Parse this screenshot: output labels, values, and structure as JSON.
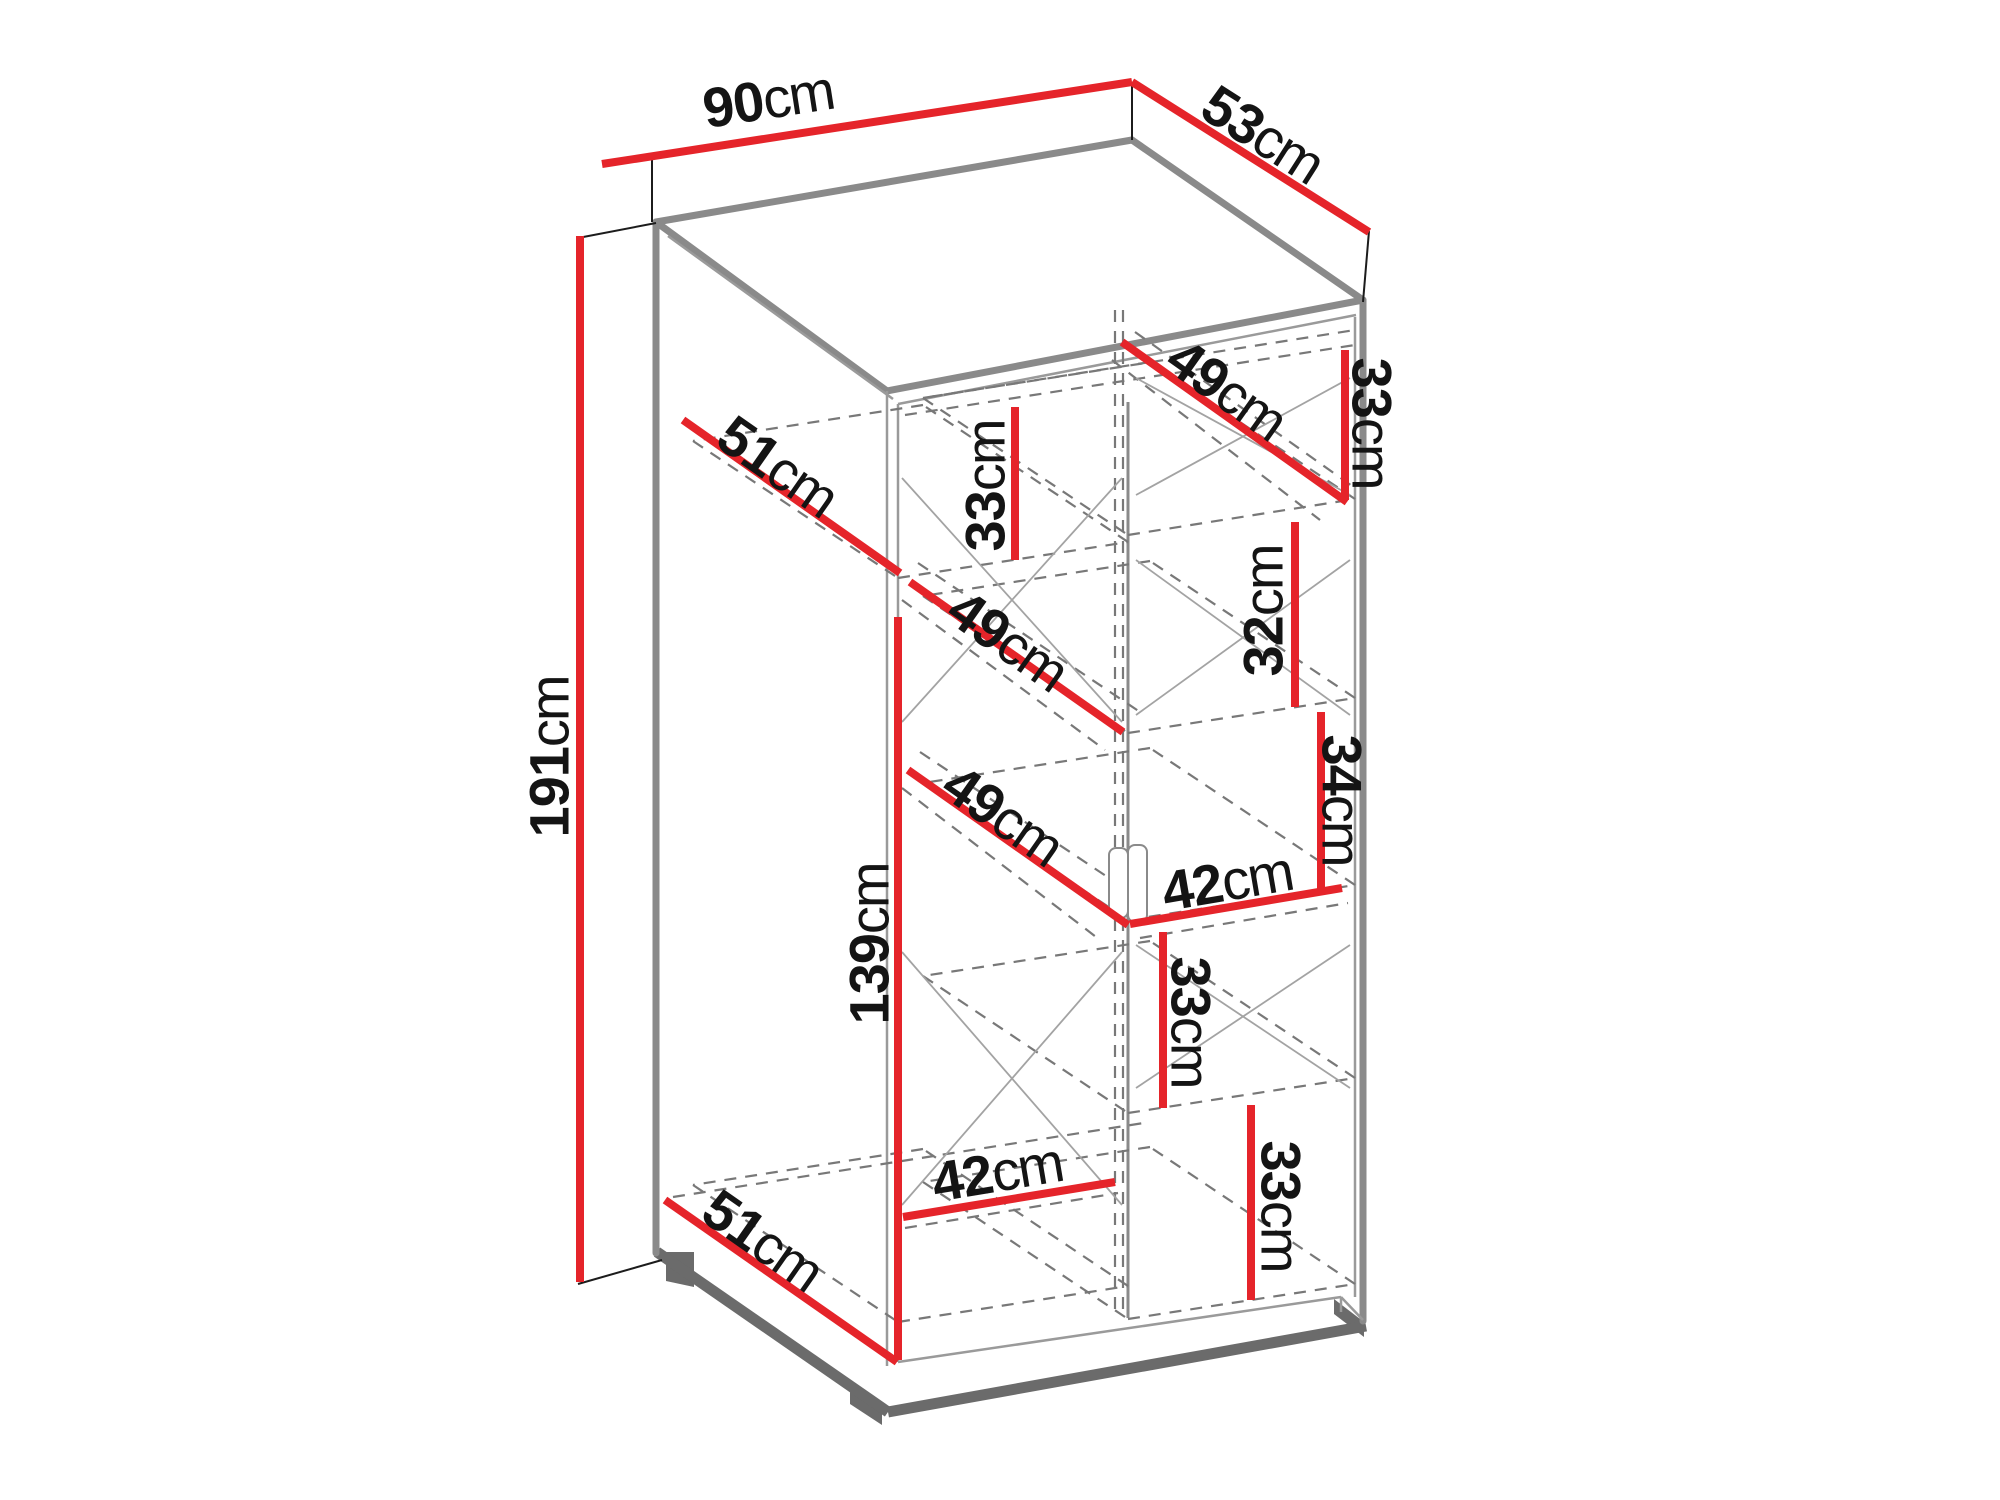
{
  "diagram": {
    "type": "furniture-dimension-diagram",
    "subject": "two-door wardrobe with interior shelves",
    "unit": "cm",
    "overall": {
      "width_cm": 90,
      "depth_cm": 53,
      "height_cm": 191
    },
    "colors": {
      "dimension_line": "#e5242a",
      "edge_gray": "#8a8a8a",
      "edge_dark": "#6b6b6b",
      "hidden_dashed": "#787878",
      "cross_brace": "#a3a3a3",
      "extension_black": "#1c1c1c",
      "text": "#141414",
      "background": "#ffffff"
    },
    "labels": [
      {
        "id": "width-top",
        "value": "90",
        "unit": "cm",
        "x": 768,
        "y": 99,
        "angle": -8.8
      },
      {
        "id": "depth-top",
        "value": "53",
        "unit": "cm",
        "x": 1263,
        "y": 134,
        "angle": 32.5
      },
      {
        "id": "height-overall",
        "value": "191",
        "unit": "cm",
        "x": 549,
        "y": 757,
        "angle": -90
      },
      {
        "id": "top-shelf-depth-left",
        "value": "51",
        "unit": "cm",
        "x": 778,
        "y": 466,
        "angle": 35
      },
      {
        "id": "top-section-height-left",
        "value": "33",
        "unit": "cm",
        "x": 985,
        "y": 486,
        "angle": -90
      },
      {
        "id": "top-shelf-depth-right",
        "value": "49",
        "unit": "cm",
        "x": 1227,
        "y": 389,
        "angle": 35.4
      },
      {
        "id": "top-section-height-right",
        "value": "33",
        "unit": "cm",
        "x": 1372,
        "y": 423,
        "angle": 90
      },
      {
        "id": "shelf-depth-left-mid",
        "value": "49",
        "unit": "cm",
        "x": 1008,
        "y": 640,
        "angle": 35.2
      },
      {
        "id": "section-height-right-2",
        "value": "32",
        "unit": "cm",
        "x": 1263,
        "y": 611,
        "angle": -90
      },
      {
        "id": "section-height-right-3",
        "value": "34",
        "unit": "cm",
        "x": 1342,
        "y": 800,
        "angle": 90
      },
      {
        "id": "section-width-right",
        "value": "42",
        "unit": "cm",
        "x": 1227,
        "y": 881,
        "angle": -9.7
      },
      {
        "id": "left-section-height",
        "value": "139",
        "unit": "cm",
        "x": 869,
        "y": 944,
        "angle": -90
      },
      {
        "id": "shelf-depth-left-lower",
        "value": "49",
        "unit": "cm",
        "x": 1003,
        "y": 815,
        "angle": 35
      },
      {
        "id": "section-height-right-4",
        "value": "33",
        "unit": "cm",
        "x": 1191,
        "y": 1022,
        "angle": 90
      },
      {
        "id": "section-width-left",
        "value": "42",
        "unit": "cm",
        "x": 997,
        "y": 1172,
        "angle": -9.5
      },
      {
        "id": "section-height-right-5",
        "value": "33",
        "unit": "cm",
        "x": 1281,
        "y": 1206,
        "angle": 90
      },
      {
        "id": "bottom-shelf-depth",
        "value": "51",
        "unit": "cm",
        "x": 763,
        "y": 1240,
        "angle": 35
      }
    ]
  }
}
